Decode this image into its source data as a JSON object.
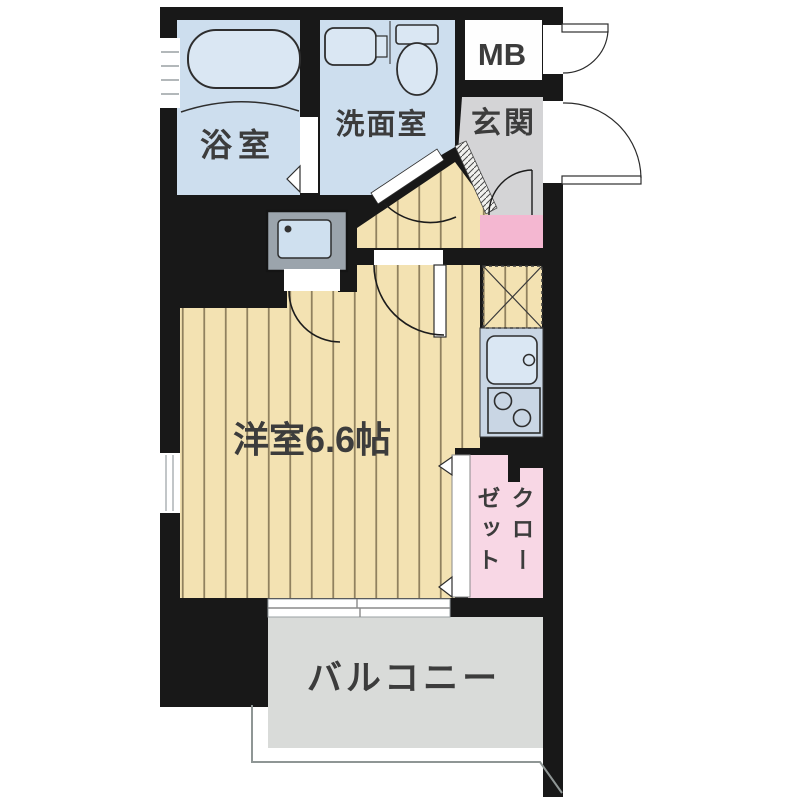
{
  "floor_plan": {
    "rooms": {
      "bathroom": {
        "label": "浴室"
      },
      "washroom": {
        "label": "洗面室"
      },
      "meter_box": {
        "label": "MB"
      },
      "entrance": {
        "label": "玄関"
      },
      "western_room": {
        "label": "洋室6.6帖"
      },
      "closet": {
        "label": "クローゼット"
      },
      "balcony": {
        "label": "バルコニー"
      }
    },
    "icons": {
      "bathtub": "bathtub-icon",
      "washbasin": "washbasin-icon",
      "toilet": "toilet-icon",
      "washing_machine": "washing-machine-icon",
      "kitchen_sink": "kitchen-sink-icon",
      "stove": "stove-burners-icon",
      "refrigerator_space": "refrigerator-space-icon",
      "door_swing": "door-swing-arc-icon",
      "folding_door": "folding-door-triangle-icon",
      "window": "window-icon"
    },
    "colors": {
      "wall": "#181818",
      "wet_room": "#cddeee",
      "fixture": "#dae7f3",
      "wood_floor": "#f3e2b2",
      "wood_stripe": "#6f6042",
      "entrance_floor": "#d4d4d6",
      "step_hatch": "#f1f1ef",
      "hall_mat": "#f4b7d1",
      "closet": "#f8d7e5",
      "kitchen_counter": "#c9d6e4",
      "balcony_floor": "#d9dbd9",
      "washer_body": "#9ba4ac",
      "washer_screen": "#cfe0ef",
      "label": "#3c3c3c",
      "balcony_label": "#616161"
    }
  }
}
